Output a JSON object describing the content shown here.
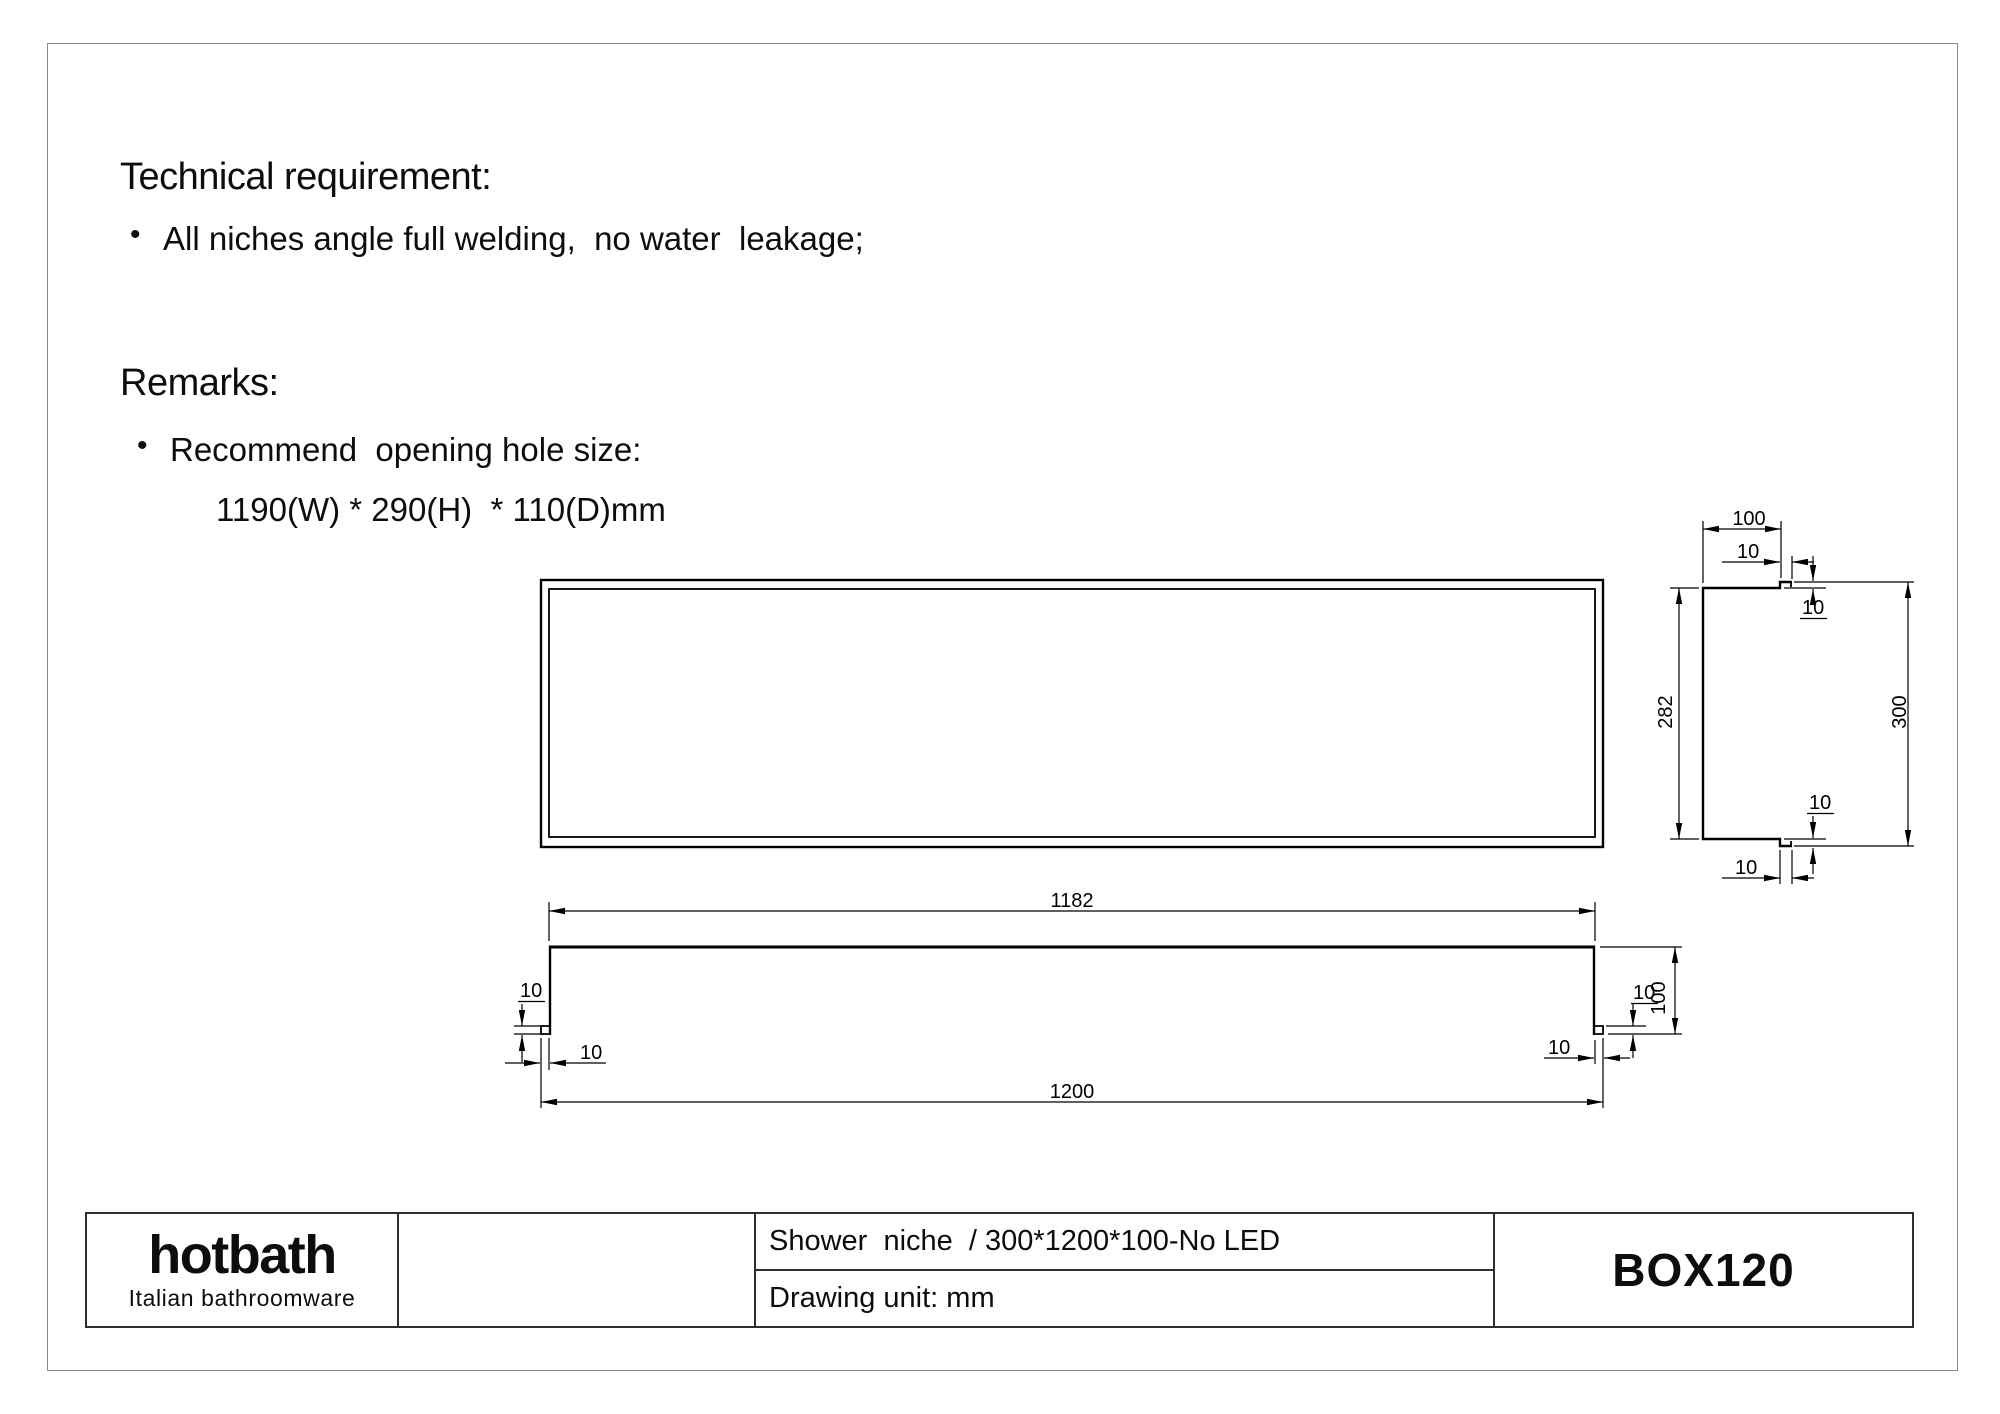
{
  "page": {
    "background": "#ffffff",
    "border_color": "#8a8a8a",
    "line_color": "#000000",
    "title_block_border_color": "#2e2e2e"
  },
  "sections": {
    "technical": {
      "heading": "Technical requirement:",
      "bullet": "All niches angle full welding,  no water  leakage;"
    },
    "remarks": {
      "heading": "Remarks:",
      "bullet": "Recommend  opening hole size:",
      "detail": "1190(W) * 290(H)  * 110(D)mm"
    }
  },
  "title_block": {
    "logo": {
      "name": "hotbath",
      "tagline": "Italian bathroomware"
    },
    "description": "Shower  niche  / 300*1200*100-No LED",
    "drawing_unit": "Drawing unit: mm",
    "model": "BOX120"
  },
  "drawing": {
    "views": [
      "front-view",
      "plan-view",
      "side-section-view"
    ],
    "dimensions_mm": {
      "overall_width": 1200,
      "inner_width": 1182,
      "overall_height": 300,
      "inner_height": 282,
      "depth": 100,
      "flange_offset": 10
    },
    "labels": [
      {
        "text": "1182",
        "x": 1072,
        "y": 907,
        "anchor": "middle"
      },
      {
        "text": "1200",
        "x": 1072,
        "y": 1098,
        "anchor": "middle"
      },
      {
        "text": "100",
        "x": 1665,
        "y": 998,
        "anchor": "middle",
        "rotate": -90
      },
      {
        "text": "10",
        "x": 1633,
        "y": 999,
        "anchor": "start",
        "underline": true
      },
      {
        "text": "10",
        "x": 1548,
        "y": 1054,
        "anchor": "start"
      },
      {
        "text": "10",
        "x": 520,
        "y": 997,
        "anchor": "start",
        "underline": true
      },
      {
        "text": "10",
        "x": 580,
        "y": 1059,
        "anchor": "start"
      },
      {
        "text": "100",
        "x": 1749,
        "y": 525,
        "anchor": "middle"
      },
      {
        "text": "10",
        "x": 1737,
        "y": 558,
        "anchor": "start"
      },
      {
        "text": "10",
        "x": 1802,
        "y": 614,
        "anchor": "start",
        "underline": true
      },
      {
        "text": "282",
        "x": 1672,
        "y": 712,
        "anchor": "middle",
        "rotate": -90
      },
      {
        "text": "300",
        "x": 1906,
        "y": 712,
        "anchor": "middle",
        "rotate": -90
      },
      {
        "text": "10",
        "x": 1809,
        "y": 809,
        "anchor": "start",
        "underline": true
      },
      {
        "text": "10",
        "x": 1735,
        "y": 874,
        "anchor": "start"
      }
    ]
  }
}
